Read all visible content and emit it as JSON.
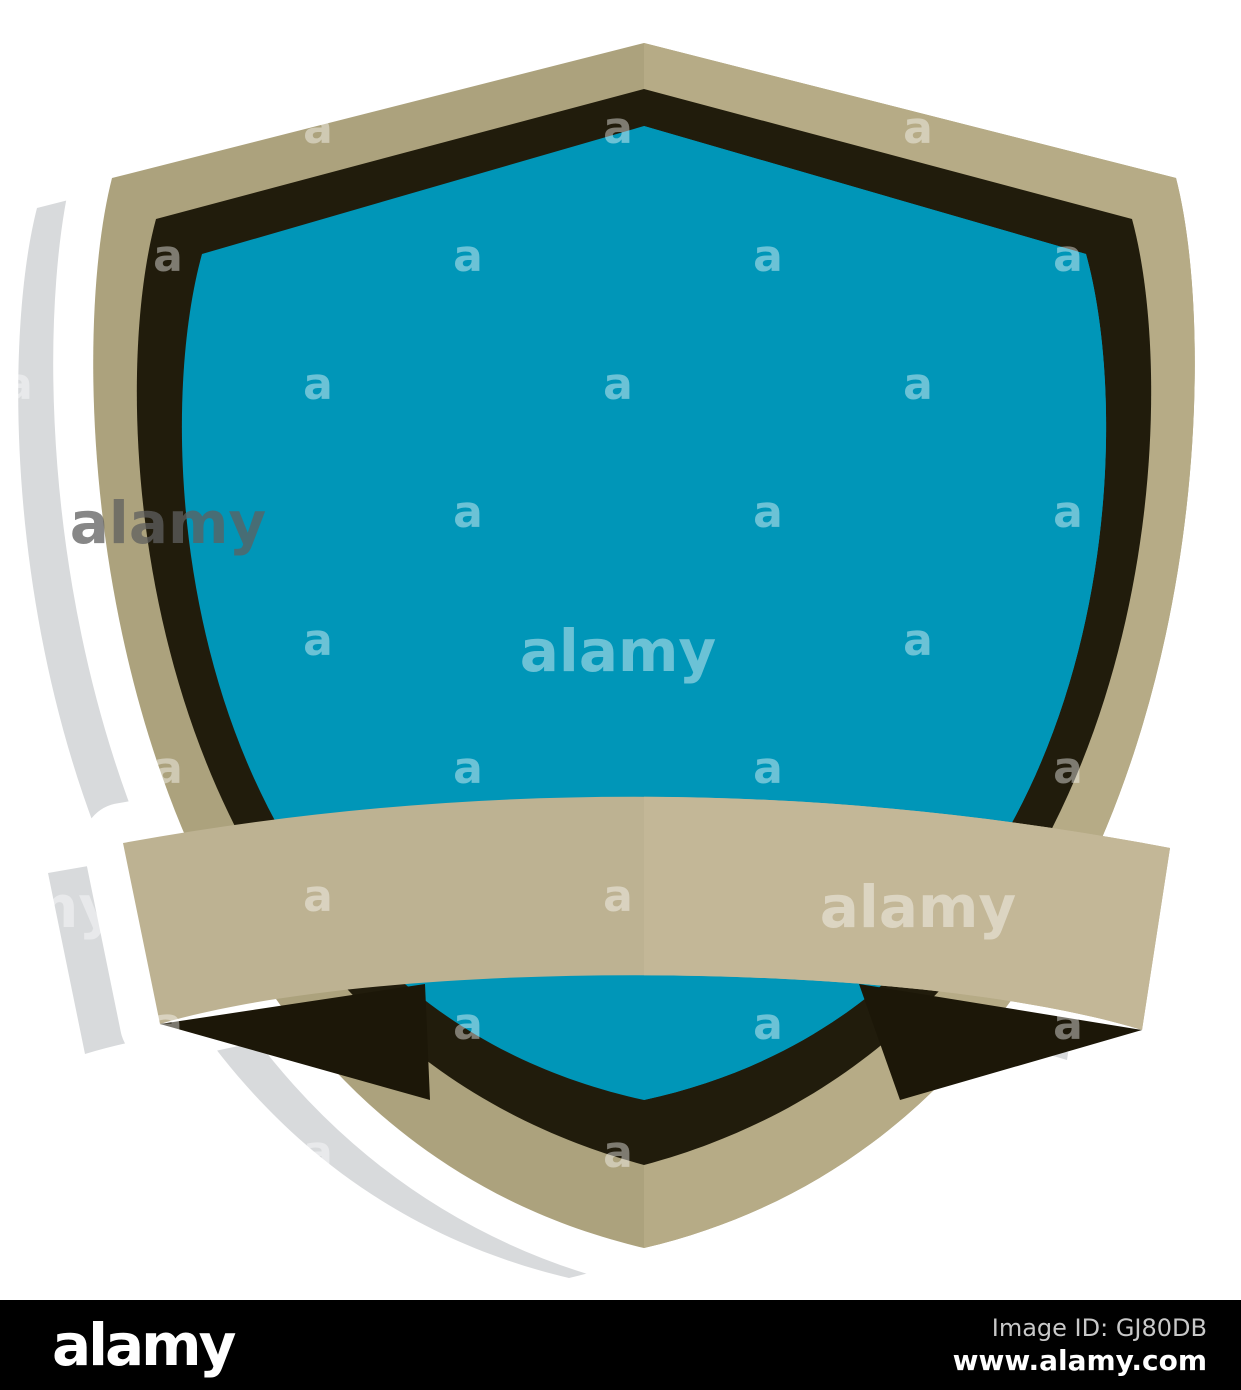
{
  "illustration": {
    "description": "Blank blue shield emblem with ribbon banner, flat sticker style with offset shadow",
    "colors": {
      "shadow": "#d8dadc",
      "sticker": "#ffffff",
      "tan_left": "#aca27d",
      "tan_right": "#b6ab86",
      "dark_border": "#211c0c",
      "fold_wedge": "#1c1708",
      "blue_left": "#0096b8",
      "blue_right": "#00aacf",
      "ribbon_left": "#bdb292",
      "ribbon_right": "#c3b797"
    }
  },
  "watermark": {
    "letter": "a",
    "word": "alamy",
    "light_color": "rgba(255,255,255,0.42)",
    "gray_color": "rgba(95,95,95,0.75)"
  },
  "footer": {
    "logo": "alamy",
    "image_id_label": "Image ID: GJ80DB",
    "website": "www.alamy.com",
    "background": "#000000"
  }
}
